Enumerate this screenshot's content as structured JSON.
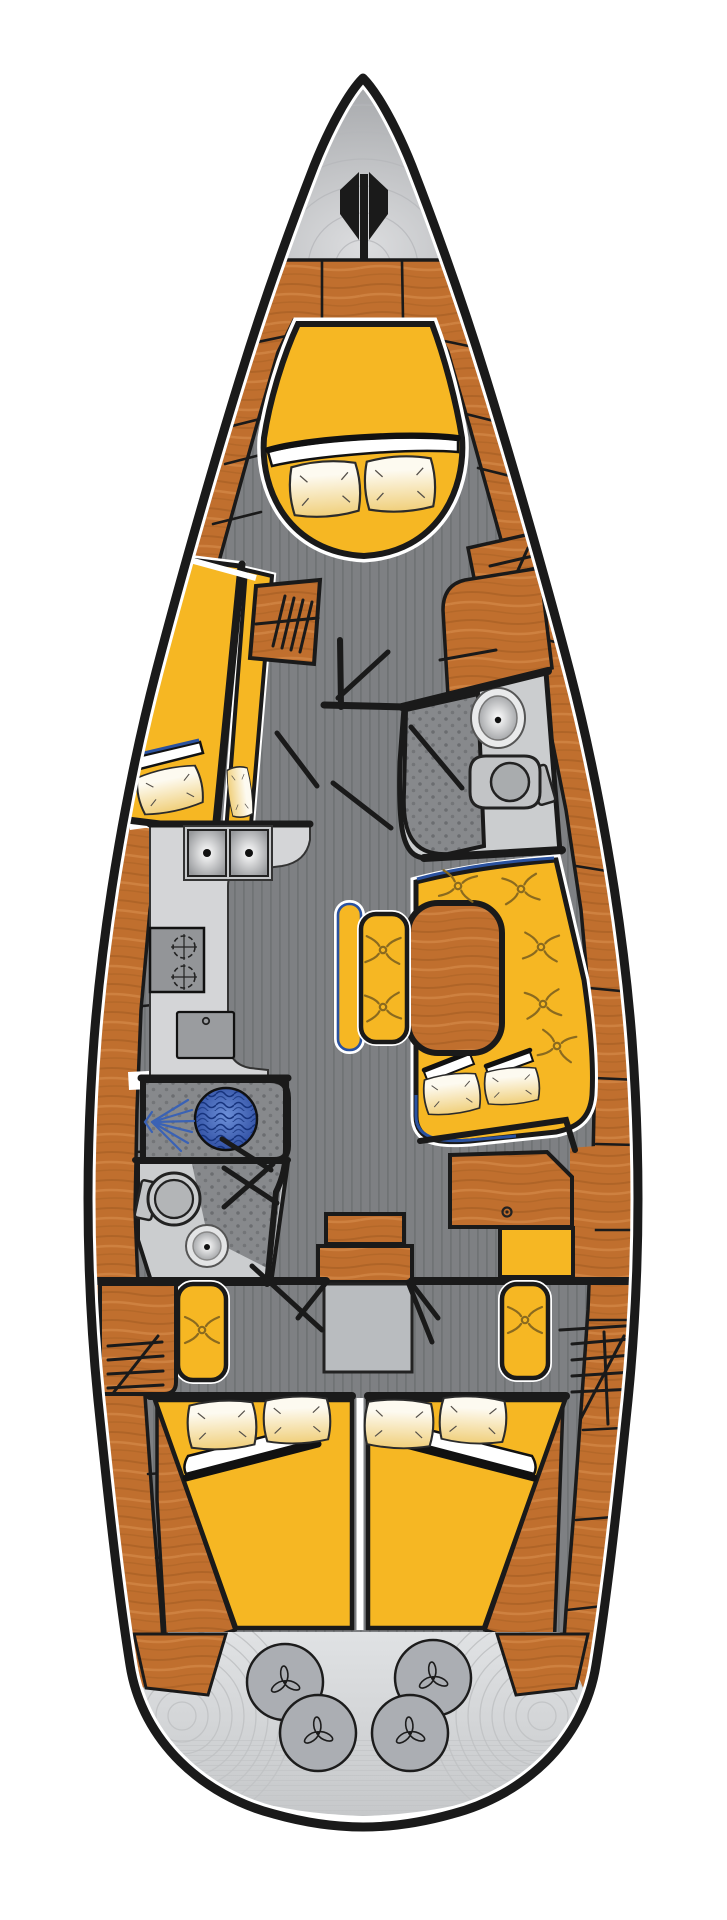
{
  "diagram": {
    "title": "Sailing yacht interior layout plan, top view",
    "type": "boat-floor-plan",
    "orientation": "bow-up"
  },
  "palette": {
    "ink": "#1a1a1a",
    "wood": "#c06f2e",
    "wood_dark": "#9e5a1f",
    "wood_light": "#d98f4f",
    "upholstery_yellow": "#f6b723",
    "pillow_cream": "#fdfaf0",
    "pillow_gold": "#f0cf7a",
    "floor_gray": "#7e8083",
    "floor_stripe": "#6d6f72",
    "room_gray": "#cbcdcf",
    "counter_gray": "#d4d5d7",
    "appliance_gray": "#939598",
    "texture_dot_gray": "#87898c",
    "water_blue": "#2f55a8",
    "spray_blue": "#3a62b5",
    "stern_metal": "#d6d8da",
    "stern_circle": "#abaeb3",
    "seat_edge_blue": "#2a52a0",
    "tuft_brown": "#8a6a1f",
    "page_bg": "#ffffff"
  },
  "regions": [
    {
      "id": "bow-locker",
      "label": "Bow anchor locker with windlass"
    },
    {
      "id": "v-berth",
      "label": "Forward cabin V-berth with two pillows"
    },
    {
      "id": "port-berth",
      "label": "Port forward single berth"
    },
    {
      "id": "forward-head",
      "label": "Forward head with wash basin and toilet"
    },
    {
      "id": "galley",
      "label": "Galley with double sink, two-burner stove and refrigerator"
    },
    {
      "id": "aft-head",
      "label": "Aft head with shower and toilet"
    },
    {
      "id": "salon",
      "label": "Salon with U-shaped settee, oval table and bench"
    },
    {
      "id": "nav-station",
      "label": "Navigation station with chart table and seat"
    },
    {
      "id": "companionway",
      "label": "Companionway steps and engine compartment"
    },
    {
      "id": "port-aft-cabin",
      "label": "Port aft double cabin"
    },
    {
      "id": "starboard-aft-cabin",
      "label": "Starboard aft double cabin"
    },
    {
      "id": "stern-platform",
      "label": "Stern platform with four hatch wheels"
    }
  ],
  "counts": {
    "pillows": 10,
    "tufted_buttons": 9,
    "stern_wheels": 4,
    "stove_burners": 2,
    "galley_sinks": 2,
    "toilets": 2,
    "wash_basins": 3,
    "showers": 2,
    "berths": 5
  },
  "fixtures": {
    "plank_dividers": [
      [
        248,
        344,
        296,
        334
      ],
      [
        232,
        426,
        280,
        414
      ],
      [
        225,
        464,
        272,
        452
      ],
      [
        213,
        524,
        261,
        512
      ],
      [
        196,
        606,
        245,
        596
      ],
      [
        183,
        668,
        231,
        658
      ],
      [
        152,
        906,
        190,
        902
      ],
      [
        143,
        1006,
        180,
        1002
      ],
      [
        136,
        1152,
        170,
        1150
      ],
      [
        136,
        1236,
        171,
        1234
      ],
      [
        140,
        1314,
        175,
        1312
      ],
      [
        148,
        1474,
        183,
        1472
      ],
      [
        156,
        1558,
        190,
        1556
      ],
      [
        163,
        1640,
        196,
        1638
      ],
      [
        430,
        338,
        478,
        348
      ],
      [
        466,
        414,
        514,
        426
      ],
      [
        478,
        468,
        526,
        480
      ],
      [
        500,
        550,
        550,
        562
      ],
      [
        523,
        634,
        571,
        646
      ],
      [
        576,
        866,
        613,
        872
      ],
      [
        589,
        988,
        631,
        992
      ],
      [
        595,
        1078,
        637,
        1080
      ],
      [
        596,
        1144,
        636,
        1145
      ],
      [
        594,
        1230,
        634,
        1230
      ],
      [
        590,
        1320,
        630,
        1320
      ],
      [
        583,
        1430,
        622,
        1428
      ],
      [
        576,
        1520,
        613,
        1517
      ],
      [
        567,
        1610,
        603,
        1606
      ],
      [
        322,
        262,
        322,
        318
      ],
      [
        402,
        262,
        403,
        318
      ]
    ],
    "door_swings": [
      [
        340,
        641,
        341,
        706
      ],
      [
        277,
        733,
        317,
        786
      ],
      [
        333,
        783,
        391,
        828
      ],
      [
        411,
        727,
        462,
        788
      ],
      [
        388,
        652,
        338,
        698
      ],
      [
        224,
        1168,
        277,
        1203
      ],
      [
        273,
        1164,
        224,
        1207
      ],
      [
        252,
        1266,
        322,
        1330
      ],
      [
        408,
        1282,
        432,
        1342
      ],
      [
        222,
        1139,
        271,
        1170
      ]
    ],
    "pillows": [
      {
        "x": 325,
        "y": 489,
        "rot": -4,
        "sx": 1,
        "sy": 1
      },
      {
        "x": 400,
        "y": 484,
        "rot": -3,
        "sx": 1,
        "sy": 1
      },
      {
        "x": 170,
        "y": 790,
        "rot": -12,
        "sx": 0.92,
        "sy": 0.78
      },
      {
        "x": 240,
        "y": 792,
        "rot": 83,
        "sx": 0.72,
        "sy": 0.42
      },
      {
        "x": 452,
        "y": 1094,
        "rot": -7,
        "sx": 0.8,
        "sy": 0.72
      },
      {
        "x": 512,
        "y": 1086,
        "rot": -5,
        "sx": 0.78,
        "sy": 0.66
      },
      {
        "x": 222,
        "y": 1425,
        "rot": -3,
        "sx": 0.98,
        "sy": 0.88
      },
      {
        "x": 297,
        "y": 1420,
        "rot": -2,
        "sx": 0.95,
        "sy": 0.85
      },
      {
        "x": 399,
        "y": 1424,
        "rot": 2,
        "sx": 0.98,
        "sy": 0.88
      },
      {
        "x": 473,
        "y": 1420,
        "rot": 3,
        "sx": 0.95,
        "sy": 0.85
      }
    ],
    "tufts": [
      [
        458,
        886,
        10
      ],
      [
        521,
        889,
        -8
      ],
      [
        541,
        947,
        5
      ],
      [
        543,
        1004,
        -6
      ],
      [
        557,
        1046,
        12
      ],
      [
        383,
        950,
        3
      ],
      [
        383,
        1007,
        -5
      ],
      [
        202,
        1330,
        0
      ],
      [
        525,
        1320,
        0
      ]
    ],
    "stern_wheels": {
      "centers": [
        [
          285,
          1682
        ],
        [
          433,
          1678
        ],
        [
          318,
          1733
        ],
        [
          410,
          1733
        ]
      ],
      "radius": 38
    },
    "stern_arc_centers": [
      [
        182,
        1716
      ],
      [
        542,
        1716
      ]
    ],
    "bow_arc_center": [
      363,
      268
    ]
  }
}
